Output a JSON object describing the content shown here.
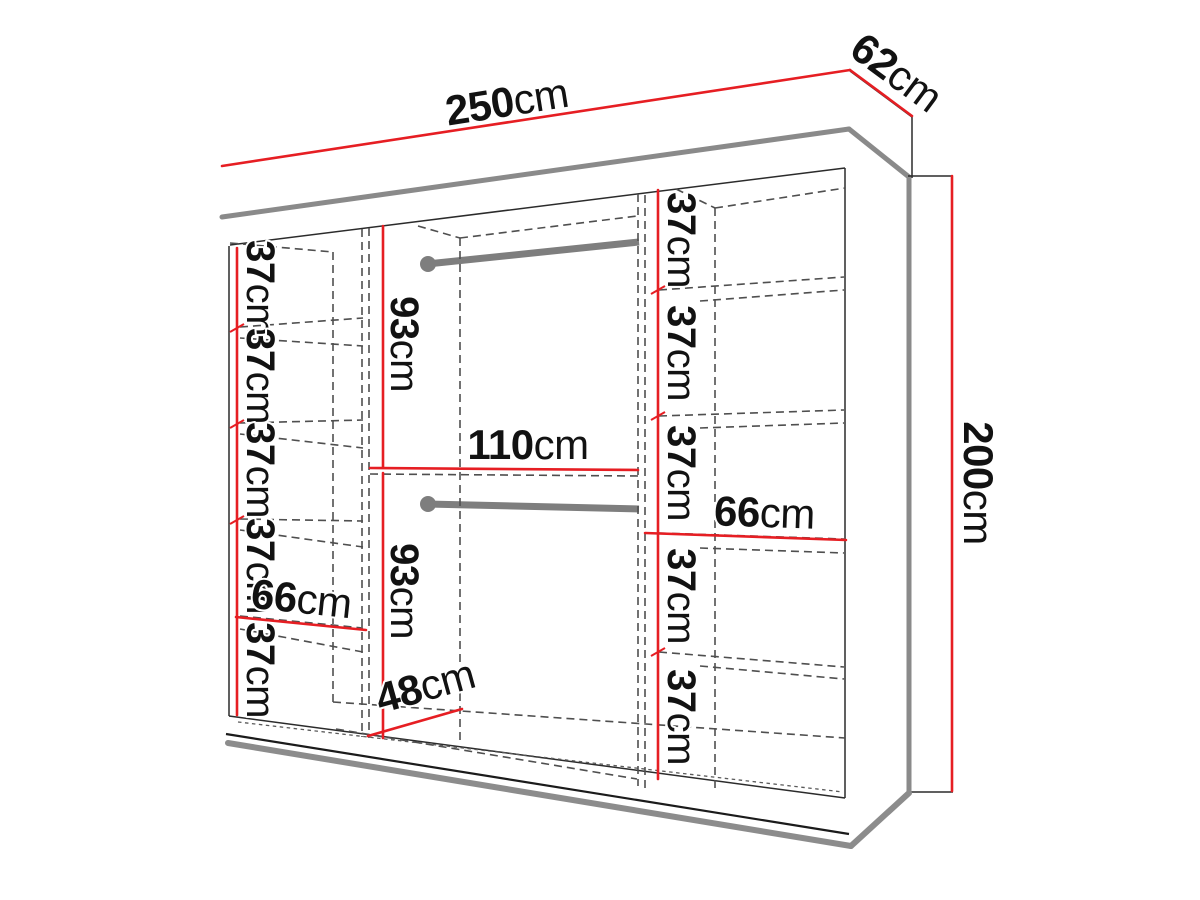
{
  "diagram": {
    "type": "wardrobe-dimension-diagram",
    "accent_color": "#e61e23",
    "structure_color": "#8a8a8a",
    "outline_color": "#1b1b1b",
    "dimensions": {
      "overall_width": {
        "value": "250",
        "unit": "cm"
      },
      "overall_depth": {
        "value": "62",
        "unit": "cm"
      },
      "overall_height": {
        "value": "200",
        "unit": "cm"
      },
      "left_column": {
        "shelf_spacings": [
          {
            "value": "37",
            "unit": "cm"
          },
          {
            "value": "37",
            "unit": "cm"
          },
          {
            "value": "37",
            "unit": "cm"
          },
          {
            "value": "37",
            "unit": "cm"
          },
          {
            "value": "37",
            "unit": "cm"
          }
        ],
        "inner_width": {
          "value": "66",
          "unit": "cm"
        }
      },
      "middle_column": {
        "upper_hanging_height": {
          "value": "93",
          "unit": "cm"
        },
        "lower_hanging_height": {
          "value": "93",
          "unit": "cm"
        },
        "inner_width": {
          "value": "110",
          "unit": "cm"
        },
        "floor_depth": {
          "value": "48",
          "unit": "cm"
        }
      },
      "right_column": {
        "shelf_spacings": [
          {
            "value": "37",
            "unit": "cm"
          },
          {
            "value": "37",
            "unit": "cm"
          },
          {
            "value": "37",
            "unit": "cm"
          },
          {
            "value": "37",
            "unit": "cm"
          },
          {
            "value": "37",
            "unit": "cm"
          }
        ],
        "inner_width": {
          "value": "66",
          "unit": "cm"
        }
      }
    }
  }
}
